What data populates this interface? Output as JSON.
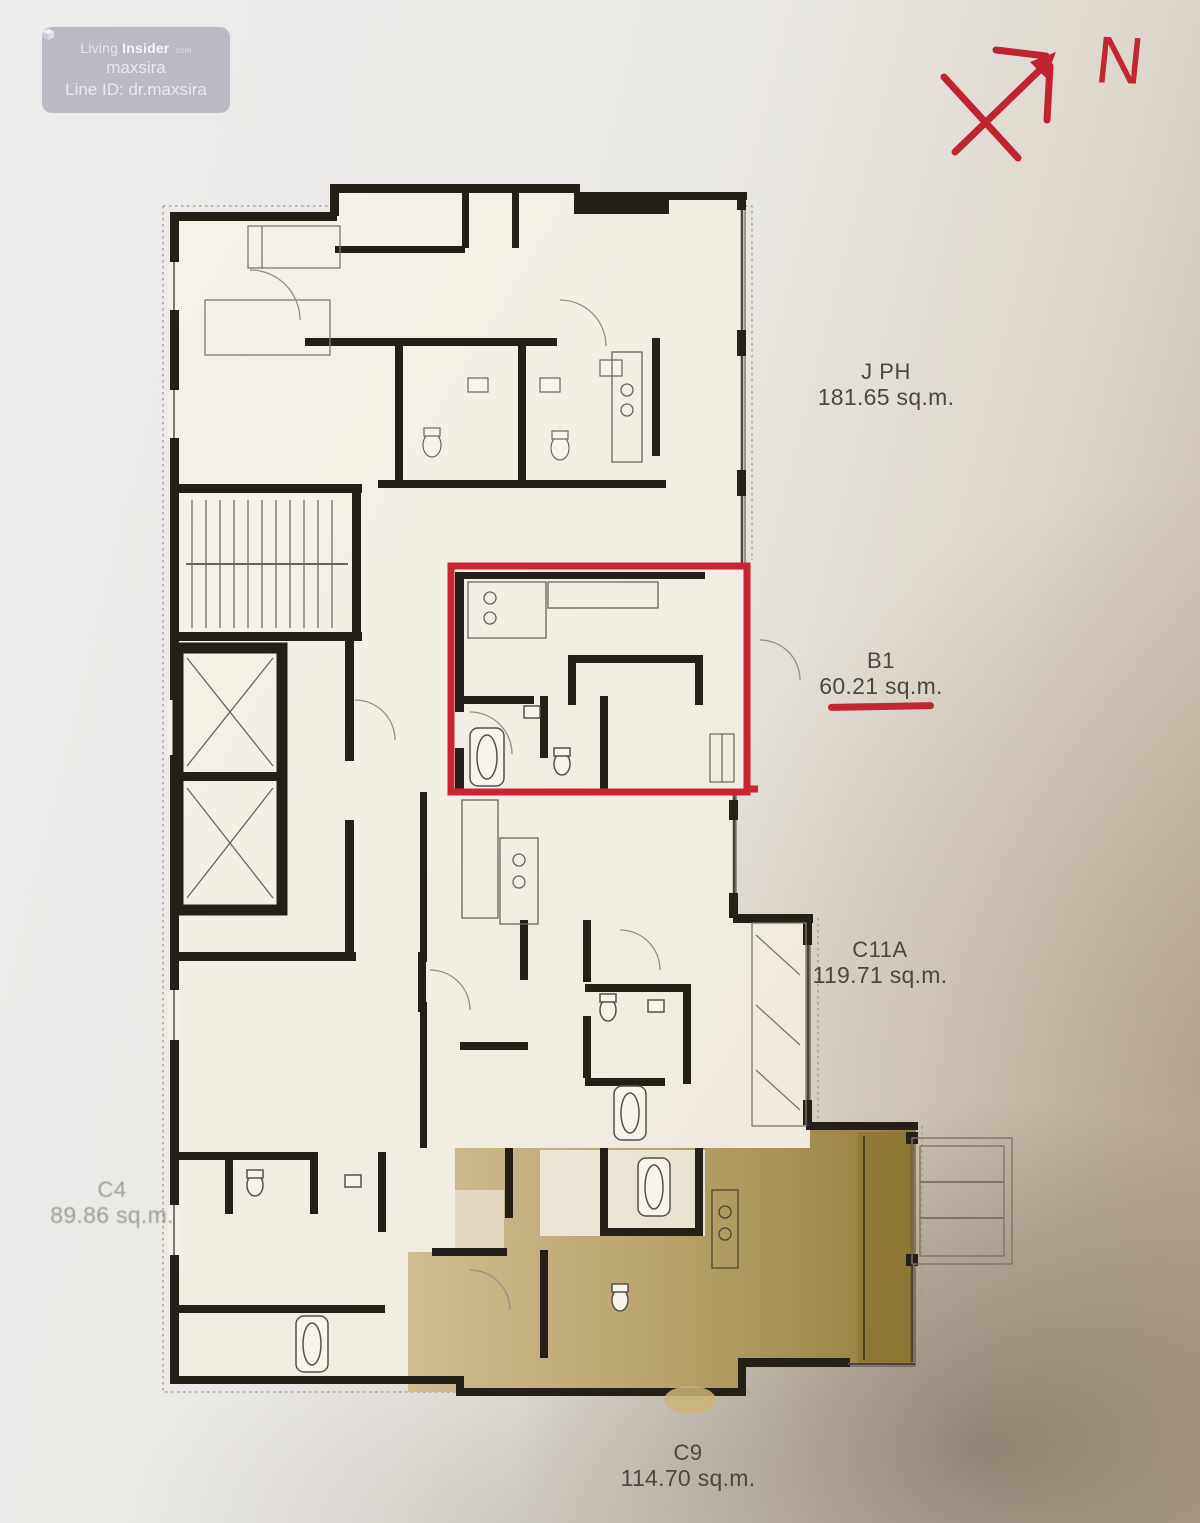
{
  "watermark": {
    "brand_light": "Living",
    "brand_bold": "Insider",
    "brand_suffix": ".com",
    "username": "maxsira",
    "line_id": "Line ID: dr.maxsira"
  },
  "compass": {
    "north_label": "N"
  },
  "floorplan": {
    "units": [
      {
        "id": "J PH",
        "area": "181.65 sq.m."
      },
      {
        "id": "B1",
        "area": "60.21 sq.m."
      },
      {
        "id": "C11A",
        "area": "119.71 sq.m."
      },
      {
        "id": "C4",
        "area": "89.86 sq.m."
      },
      {
        "id": "C9",
        "area": "114.70 sq.m."
      }
    ],
    "highlighted_unit": "B1",
    "shaded_unit": "C9"
  },
  "colors": {
    "annotation_red": "#c32531",
    "unit_shade_gold": "#a98f4f",
    "plan_paper": "#f2efe5",
    "wall": "#241f17",
    "label_text": "#4c4741",
    "watermark_bg": "#9292a6"
  }
}
